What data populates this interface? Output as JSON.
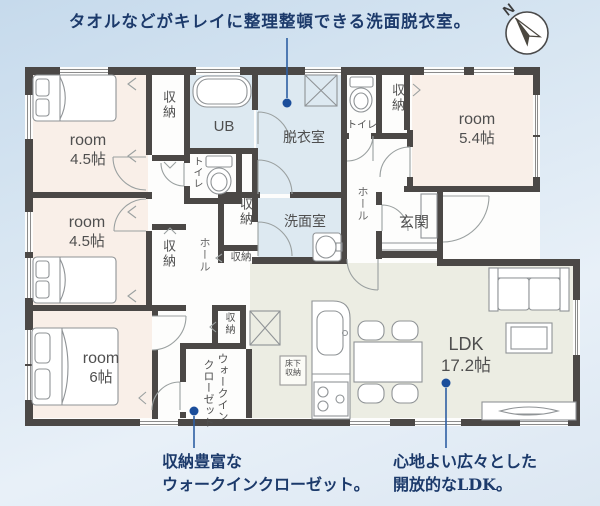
{
  "annotations": {
    "top": {
      "text": "タオルなどがキレイに整理整頓できる洗面脱衣室。"
    },
    "bottom_left": {
      "line1": "収納豊富な",
      "line2": "ウォークインクローゼット。"
    },
    "bottom_right": {
      "line1": "心地よい広々とした",
      "line2": "開放的なLDK。"
    }
  },
  "compass": {
    "label": "N"
  },
  "rooms": {
    "room1": {
      "name": "room",
      "size": "4.5帖"
    },
    "room2": {
      "name": "room",
      "size": "5.4帖"
    },
    "room3": {
      "name": "room",
      "size": "4.5帖"
    },
    "room4": {
      "name": "room",
      "size": "6帖"
    },
    "ldk": {
      "name": "LDK",
      "size": "17.2帖"
    },
    "ub": "UB",
    "dressing_room": "脱衣室",
    "washroom": "洗面室",
    "entrance": "玄関",
    "toilet": "トイレ",
    "hall": "ホール",
    "storage": "収納",
    "wic": {
      "line1": "ウォークイン",
      "line2": "クローゼット"
    },
    "underfloor": {
      "line1": "床下",
      "line2": "収納"
    }
  },
  "colors": {
    "wall": "#4b4846",
    "room_pink": "#f9efe8",
    "wet_blue": "#dde9f1",
    "ldk_green": "#ecede3",
    "annotation_navy": "#1c3a6b",
    "marker_blue": "#1b4e9b"
  }
}
